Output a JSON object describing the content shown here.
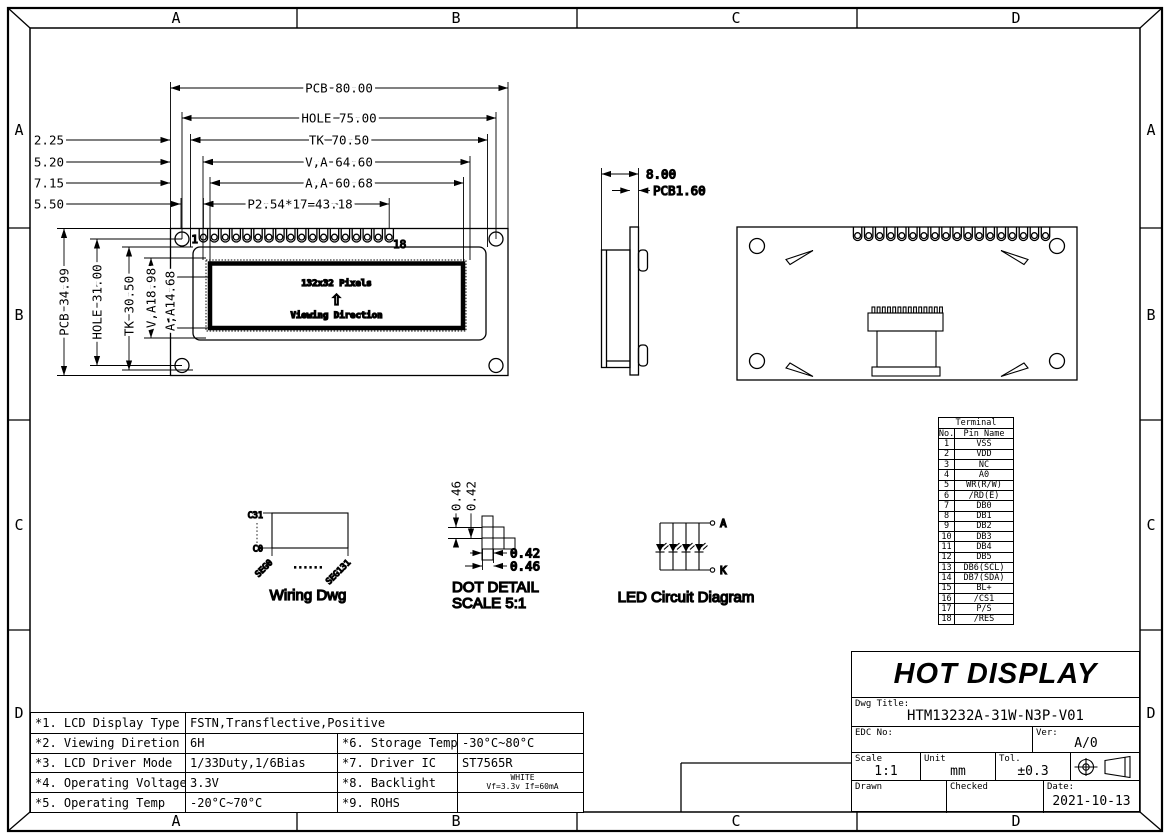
{
  "frame": {
    "cols": [
      "A",
      "B",
      "C",
      "D"
    ],
    "rows": [
      "A",
      "B",
      "C",
      "D"
    ]
  },
  "front_view": {
    "dim_pcb_w": "PCB 80.00",
    "dim_hole_w": "HOLE 75.00",
    "dim_tk_w": "TK 70.50",
    "dim_va_w": "V,A 64.60",
    "dim_aa_w": "A,A 60.68",
    "dim_pitch": "P2.54*17=43.18",
    "offset_dims": [
      "2.25",
      "5.20",
      "7.15",
      "5.50"
    ],
    "dim_pcb_h": "PCB 34.99",
    "dim_hole_h": "HOLE 31.00",
    "dim_tk_h": "TK 30.50",
    "dim_va_h": "V,A18.98",
    "dim_aa_h": "A,A14.68",
    "pin_first": "1",
    "pin_last": "18",
    "lcd_pixels": "132x32 Pixels",
    "viewing_arrow": "⇧",
    "viewing_direction": "Viewing Direction"
  },
  "side_view": {
    "dim_width": "8.00",
    "dim_pcb_thickness": "PCB1.60"
  },
  "wiring_dwg": {
    "com_top": "C31",
    "com_bottom": "C0",
    "seg_first": "SEG0",
    "seg_dots": "......",
    "seg_last": "SEG131",
    "caption": "Wiring Dwg"
  },
  "dot_detail": {
    "dim_col_outer": "0.46",
    "dim_col_inner": "0.42",
    "dim_row_inner": "0.42",
    "dim_row_outer": "0.46",
    "caption": "DOT DETAIL",
    "scale_note": "SCALE 5:1"
  },
  "led_circuit": {
    "anode": "A",
    "cathode": "K",
    "caption": "LED Circuit Diagram"
  },
  "terminal_table": {
    "title": "Terminal",
    "col_no": "No.",
    "col_pin": "Pin Name",
    "rows": [
      [
        "1",
        "VSS"
      ],
      [
        "2",
        "VDD"
      ],
      [
        "3",
        "NC"
      ],
      [
        "4",
        "A0"
      ],
      [
        "5",
        "WR(R/W)"
      ],
      [
        "6",
        "/RD(E)"
      ],
      [
        "7",
        "DB0"
      ],
      [
        "8",
        "DB1"
      ],
      [
        "9",
        "DB2"
      ],
      [
        "10",
        "DB3"
      ],
      [
        "11",
        "DB4"
      ],
      [
        "12",
        "DB5"
      ],
      [
        "13",
        "DB6(SCL)"
      ],
      [
        "14",
        "DB7(SDA)"
      ],
      [
        "15",
        "BL+"
      ],
      [
        "16",
        "/CS1"
      ],
      [
        "17",
        "P/S"
      ],
      [
        "18",
        "/RES"
      ]
    ]
  },
  "title_block": {
    "company": "HOT DISPLAY",
    "dwg_title_label": "Dwg Title:",
    "dwg_title": "HTM13232A-31W-N3P-V01",
    "edc_label": "EDC No:",
    "ver_label": "Ver:",
    "ver": "A/0",
    "scale_label": "Scale",
    "scale": "1:1",
    "unit_label": "Unit",
    "unit": "mm",
    "tol_label": "Tol.",
    "tol": "±0.3",
    "drawn_label": "Drawn",
    "checked_label": "Checked",
    "date_label": "Date:",
    "date": "2021-10-13"
  },
  "spec_table": {
    "row1_label": "*1. LCD Display Type",
    "row1_value": "FSTN,Transflective,Positive",
    "rows": [
      {
        "l1": "*2. Viewing Diretion",
        "v1": "6H",
        "l2": "*6. Storage Temp",
        "v2": "-30°C~80°C",
        "v2b": ""
      },
      {
        "l1": "*3. LCD Driver Mode",
        "v1": "1/33Duty,1/6Bias",
        "l2": "*7. Driver IC",
        "v2": "ST7565R",
        "v2b": ""
      },
      {
        "l1": "*4. Operating Voltage",
        "v1": "3.3V",
        "l2": "*8. Backlight",
        "v2": "WHITE",
        "v2b": "Vf=3.3v If=60mA"
      },
      {
        "l1": "*5. Operating Temp",
        "v1": "-20°C~70°C",
        "l2": "*9. ROHS",
        "v2": "",
        "v2b": ""
      }
    ]
  }
}
